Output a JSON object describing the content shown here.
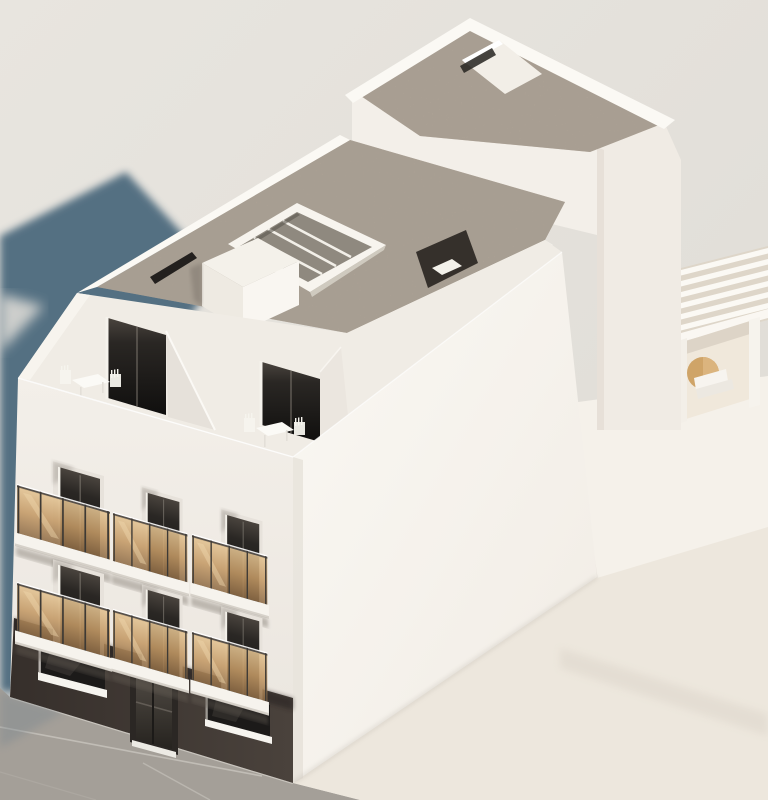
{
  "meta": {
    "title": "Architectural 3D exterior rendering",
    "subject": "White four-storey apartment building",
    "view": "Aerial three-quarter view from the front-left"
  },
  "palette": {
    "background": "#e5e2dc",
    "background_dark": "#dbd8d2",
    "shadow_blue": "#4d6a7e",
    "wall_white": "#f1ede6",
    "wall_shaded": "#e9e4dd",
    "side_wall": "#f8f5ef",
    "gravel_roof": "#b3a798",
    "parapet_white": "#fbf9f4",
    "amber_glass": "#c49a66",
    "amber_glass_light": "#e2c291",
    "railing_metal": "#3e3a35",
    "opening_dark": "#16141300",
    "opening_top": "#433d38",
    "opening_bottom": "#121110",
    "ground_floor_dark": "#3f3833",
    "storefront_glass": "#1c1a19",
    "sill_white": "#f6f4ef",
    "sidewalk_gray": "#a5a19b",
    "sidewalk_joint": "#c9c5be",
    "pavement_light": "#ede7dd",
    "attic_floor": "#f0ece5",
    "skylight_glass": "#8f897f",
    "parasol_tan": "#cfa468",
    "interior_warm": "#f0e8db"
  },
  "scene": {
    "building": {
      "floors_visible": 4,
      "balcony_count": 6,
      "balcony_rows": 2,
      "balcony_columns": 3,
      "features": [
        "gravel flat roof",
        "glass skylight with mullions",
        "white roof-access bulkhead",
        "recessed attic terraces with bistro tables and chairs",
        "amber glass balcony railings with dark posts",
        "dark charcoal commercial ground floor",
        "central glass entrance door",
        "two storefront windows with white sills",
        "rear raised roof block",
        "rooftop pergola terrace with tan parasol and white lounger"
      ]
    },
    "environment": {
      "ground": "concrete sidewalk with expansion joints, lighter pavement to the right",
      "lighting": "sunlight from the upper right casting a soft blue-gray shadow to the upper left"
    }
  },
  "accessibility": {
    "figure_label": "Architectural 3D rendering of a white four-storey apartment building with six amber glass balconies, a dark commercial ground floor, recessed attic terraces, a gravel flat roof with skylight, and a rooftop pergola terrace with a tan parasol."
  }
}
